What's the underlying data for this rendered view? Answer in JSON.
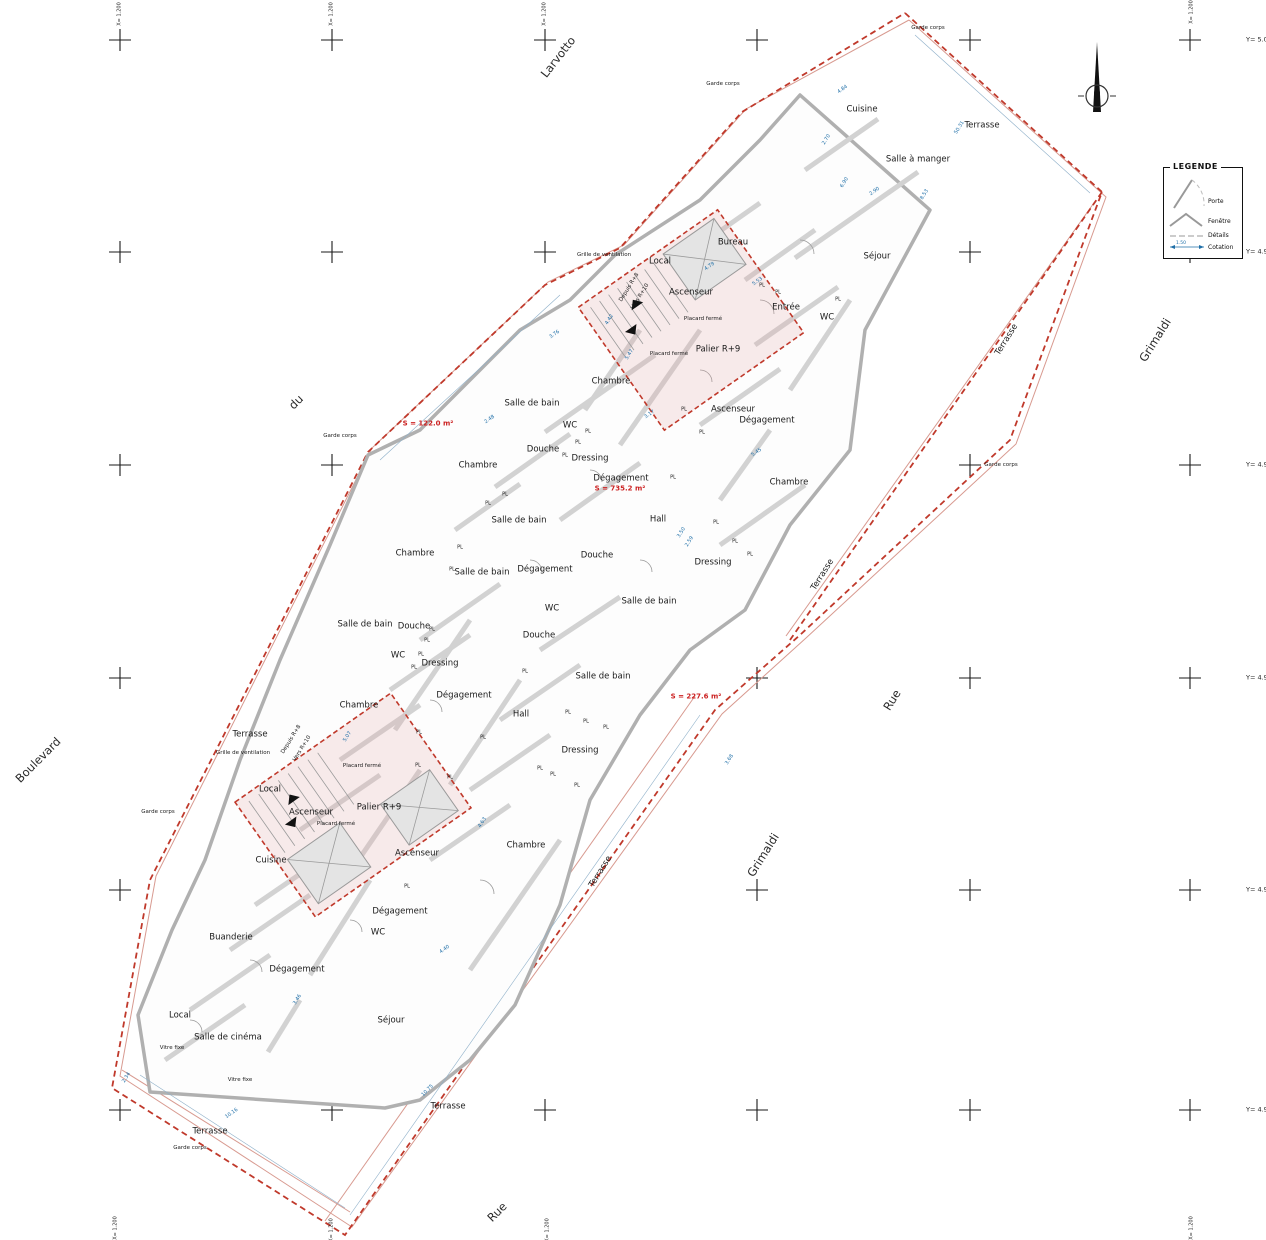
{
  "plan": {
    "level_name": "Palier R+9",
    "boundary_color": "#c0392b",
    "dimension_color": "#1f6fa8",
    "area_color": "#cc2222"
  },
  "legend": {
    "title": "LEGENDE",
    "items": [
      {
        "label": "Porte"
      },
      {
        "label": "Fenêtre"
      },
      {
        "label": "Détails"
      },
      {
        "label": "Cotation"
      }
    ],
    "cotation_value": "1.50"
  },
  "north": {
    "label": "N"
  },
  "grid": {
    "cols": [
      120,
      332,
      545,
      757,
      970,
      1190
    ],
    "rows": [
      40,
      252,
      465,
      678,
      890,
      1110
    ],
    "y_labels": [
      {
        "t": "Y= 5.000",
        "x": 1246,
        "y": 40
      },
      {
        "t": "Y= 4.990",
        "x": 1246,
        "y": 252
      },
      {
        "t": "Y= 4.980",
        "x": 1246,
        "y": 465
      },
      {
        "t": "Y= 4.970",
        "x": 1246,
        "y": 678
      },
      {
        "t": "Y= 4.960",
        "x": 1246,
        "y": 890
      },
      {
        "t": "Y= 4.950",
        "x": 1246,
        "y": 1110
      }
    ],
    "x_labels": [
      {
        "t": "X= 1.200",
        "x": 120,
        "y": 14
      },
      {
        "t": "X= 1.200",
        "x": 332,
        "y": 14
      },
      {
        "t": "X= 1.200",
        "x": 545,
        "y": 14
      },
      {
        "t": "X= 1.200",
        "x": 1192,
        "y": 12
      },
      {
        "t": "X= 1.200",
        "x": 116,
        "y": 1228
      },
      {
        "t": "X= 1.200",
        "x": 332,
        "y": 1230
      },
      {
        "t": "X= 1.200",
        "x": 548,
        "y": 1230
      },
      {
        "t": "X= 1.200",
        "x": 1192,
        "y": 1228
      }
    ]
  },
  "labels": [
    {
      "t": "Larvotto",
      "x": 558,
      "y": 57,
      "r": -52,
      "c": "street"
    },
    {
      "t": "du",
      "x": 296,
      "y": 402,
      "r": -45,
      "c": "street"
    },
    {
      "t": "Boulevard",
      "x": 38,
      "y": 760,
      "r": -45,
      "c": "street"
    },
    {
      "t": "Grimaldi",
      "x": 1155,
      "y": 340,
      "r": -58,
      "c": "street"
    },
    {
      "t": "Grimaldi",
      "x": 763,
      "y": 855,
      "r": -58,
      "c": "street"
    },
    {
      "t": "Rue",
      "x": 892,
      "y": 700,
      "r": -58,
      "c": "street"
    },
    {
      "t": "Rue",
      "x": 497,
      "y": 1212,
      "r": -45,
      "c": "street"
    },
    {
      "t": "S = 122.0 m²",
      "x": 428,
      "y": 424,
      "r": 0,
      "c": "area"
    },
    {
      "t": "S = 735.2 m²",
      "x": 620,
      "y": 489,
      "r": 0,
      "c": "area"
    },
    {
      "t": "S = 227.6 m²",
      "x": 696,
      "y": 697,
      "r": 0,
      "c": "area"
    },
    {
      "t": "Cuisine",
      "x": 862,
      "y": 110,
      "r": 0,
      "c": "room"
    },
    {
      "t": "Terrasse",
      "x": 982,
      "y": 126,
      "r": 0,
      "c": "room"
    },
    {
      "t": "Salle à manger",
      "x": 918,
      "y": 160,
      "r": 0,
      "c": "room"
    },
    {
      "t": "Séjour",
      "x": 877,
      "y": 257,
      "r": 0,
      "c": "room"
    },
    {
      "t": "Bureau",
      "x": 733,
      "y": 243,
      "r": 0,
      "c": "room"
    },
    {
      "t": "Local",
      "x": 660,
      "y": 262,
      "r": 0,
      "c": "room"
    },
    {
      "t": "Ascenseur",
      "x": 691,
      "y": 293,
      "r": 0,
      "c": "room"
    },
    {
      "t": "Entrée",
      "x": 786,
      "y": 308,
      "r": 0,
      "c": "room"
    },
    {
      "t": "WC",
      "x": 827,
      "y": 318,
      "r": 0,
      "c": "room"
    },
    {
      "t": "Palier R+9",
      "x": 718,
      "y": 350,
      "r": 0,
      "c": "room"
    },
    {
      "t": "Ascenseur",
      "x": 733,
      "y": 410,
      "r": 0,
      "c": "room"
    },
    {
      "t": "Dégagement",
      "x": 767,
      "y": 421,
      "r": 0,
      "c": "room"
    },
    {
      "t": "Chambre",
      "x": 789,
      "y": 483,
      "r": 0,
      "c": "room"
    },
    {
      "t": "Terrasse",
      "x": 823,
      "y": 575,
      "r": -58,
      "c": "room"
    },
    {
      "t": "Terrasse",
      "x": 1007,
      "y": 340,
      "r": -58,
      "c": "room"
    },
    {
      "t": "Chambre",
      "x": 611,
      "y": 382,
      "r": 0,
      "c": "room"
    },
    {
      "t": "Salle de bain",
      "x": 532,
      "y": 404,
      "r": 0,
      "c": "room"
    },
    {
      "t": "WC",
      "x": 570,
      "y": 426,
      "r": 0,
      "c": "room"
    },
    {
      "t": "Douche",
      "x": 543,
      "y": 450,
      "r": 0,
      "c": "room"
    },
    {
      "t": "Dressing",
      "x": 590,
      "y": 459,
      "r": 0,
      "c": "room"
    },
    {
      "t": "Dégagement",
      "x": 621,
      "y": 479,
      "r": 0,
      "c": "room"
    },
    {
      "t": "Chambre",
      "x": 478,
      "y": 466,
      "r": 0,
      "c": "room"
    },
    {
      "t": "Salle de bain",
      "x": 519,
      "y": 521,
      "r": 0,
      "c": "room"
    },
    {
      "t": "Dégagement",
      "x": 545,
      "y": 570,
      "r": 0,
      "c": "room"
    },
    {
      "t": "Chambre",
      "x": 415,
      "y": 554,
      "r": 0,
      "c": "room"
    },
    {
      "t": "Salle de bain",
      "x": 482,
      "y": 573,
      "r": 0,
      "c": "room"
    },
    {
      "t": "WC",
      "x": 552,
      "y": 609,
      "r": 0,
      "c": "room"
    },
    {
      "t": "Douche",
      "x": 597,
      "y": 556,
      "r": 0,
      "c": "room"
    },
    {
      "t": "Hall",
      "x": 658,
      "y": 520,
      "r": 0,
      "c": "room"
    },
    {
      "t": "Douche",
      "x": 539,
      "y": 636,
      "r": 0,
      "c": "room"
    },
    {
      "t": "Salle de bain",
      "x": 365,
      "y": 625,
      "r": 0,
      "c": "room"
    },
    {
      "t": "Douche",
      "x": 414,
      "y": 627,
      "r": 0,
      "c": "room"
    },
    {
      "t": "WC",
      "x": 398,
      "y": 656,
      "r": 0,
      "c": "room"
    },
    {
      "t": "Dressing",
      "x": 440,
      "y": 664,
      "r": 0,
      "c": "room"
    },
    {
      "t": "Dégagement",
      "x": 464,
      "y": 696,
      "r": 0,
      "c": "room"
    },
    {
      "t": "Chambre",
      "x": 359,
      "y": 706,
      "r": 0,
      "c": "room"
    },
    {
      "t": "Salle de bain",
      "x": 603,
      "y": 677,
      "r": 0,
      "c": "room"
    },
    {
      "t": "Dressing",
      "x": 580,
      "y": 751,
      "r": 0,
      "c": "room"
    },
    {
      "t": "Salle de bain",
      "x": 649,
      "y": 602,
      "r": 0,
      "c": "room"
    },
    {
      "t": "Dressing",
      "x": 713,
      "y": 563,
      "r": 0,
      "c": "room"
    },
    {
      "t": "Hall",
      "x": 521,
      "y": 715,
      "r": 0,
      "c": "room"
    },
    {
      "t": "Terrasse",
      "x": 250,
      "y": 735,
      "r": 0,
      "c": "room"
    },
    {
      "t": "Local",
      "x": 270,
      "y": 790,
      "r": 0,
      "c": "room"
    },
    {
      "t": "Ascenseur",
      "x": 311,
      "y": 813,
      "r": 0,
      "c": "room"
    },
    {
      "t": "Palier R+9",
      "x": 379,
      "y": 808,
      "r": 0,
      "c": "room"
    },
    {
      "t": "Ascenseur",
      "x": 417,
      "y": 854,
      "r": 0,
      "c": "room"
    },
    {
      "t": "Cuisine",
      "x": 271,
      "y": 861,
      "r": 0,
      "c": "room"
    },
    {
      "t": "Chambre",
      "x": 526,
      "y": 846,
      "r": 0,
      "c": "room"
    },
    {
      "t": "Dégagement",
      "x": 400,
      "y": 912,
      "r": 0,
      "c": "room"
    },
    {
      "t": "WC",
      "x": 378,
      "y": 933,
      "r": 0,
      "c": "room"
    },
    {
      "t": "Buanderie",
      "x": 231,
      "y": 938,
      "r": 0,
      "c": "room"
    },
    {
      "t": "Dégagement",
      "x": 297,
      "y": 970,
      "r": 0,
      "c": "room"
    },
    {
      "t": "Local",
      "x": 180,
      "y": 1016,
      "r": 0,
      "c": "room"
    },
    {
      "t": "Salle de cinéma",
      "x": 228,
      "y": 1038,
      "r": 0,
      "c": "room"
    },
    {
      "t": "Séjour",
      "x": 391,
      "y": 1021,
      "r": 0,
      "c": "room"
    },
    {
      "t": "Terrasse",
      "x": 601,
      "y": 872,
      "r": -58,
      "c": "room"
    },
    {
      "t": "Terrasse",
      "x": 448,
      "y": 1107,
      "r": 0,
      "c": "room"
    },
    {
      "t": "Terrasse",
      "x": 210,
      "y": 1132,
      "r": 0,
      "c": "room"
    },
    {
      "t": "Garde corps",
      "x": 340,
      "y": 437,
      "r": 0,
      "c": "tiny"
    },
    {
      "t": "Garde corps",
      "x": 723,
      "y": 85,
      "r": 0,
      "c": "tiny"
    },
    {
      "t": "Garde corps",
      "x": 928,
      "y": 29,
      "r": 0,
      "c": "tiny"
    },
    {
      "t": "Garde corps",
      "x": 1001,
      "y": 466,
      "r": 0,
      "c": "tiny"
    },
    {
      "t": "Garde corps",
      "x": 158,
      "y": 813,
      "r": 0,
      "c": "tiny"
    },
    {
      "t": "Garde corps",
      "x": 190,
      "y": 1149,
      "r": 0,
      "c": "tiny"
    },
    {
      "t": "Grille de ventilation",
      "x": 604,
      "y": 256,
      "r": 0,
      "c": "tiny"
    },
    {
      "t": "Grille de ventilation",
      "x": 243,
      "y": 754,
      "r": 0,
      "c": "tiny"
    },
    {
      "t": "Placard fermé",
      "x": 703,
      "y": 320,
      "r": 0,
      "c": "tiny"
    },
    {
      "t": "Placard fermé",
      "x": 669,
      "y": 355,
      "r": 0,
      "c": "tiny"
    },
    {
      "t": "Placard fermé",
      "x": 362,
      "y": 767,
      "r": 0,
      "c": "tiny"
    },
    {
      "t": "Placard fermé",
      "x": 336,
      "y": 825,
      "r": 0,
      "c": "tiny"
    },
    {
      "t": "Vitre fixe",
      "x": 172,
      "y": 1049,
      "r": 0,
      "c": "tiny"
    },
    {
      "t": "Vitre fixe",
      "x": 240,
      "y": 1081,
      "r": 0,
      "c": "tiny"
    },
    {
      "t": "Depuis R+8",
      "x": 630,
      "y": 288,
      "r": -58,
      "c": "tiny"
    },
    {
      "t": "Vers R+10",
      "x": 641,
      "y": 297,
      "r": -58,
      "c": "tiny"
    },
    {
      "t": "Depuis R+8",
      "x": 292,
      "y": 740,
      "r": -58,
      "c": "tiny"
    },
    {
      "t": "Vers R+10",
      "x": 303,
      "y": 749,
      "r": -58,
      "c": "tiny"
    },
    {
      "t": "PL",
      "x": 684,
      "y": 410,
      "r": 0,
      "c": "pl"
    },
    {
      "t": "PL",
      "x": 702,
      "y": 433,
      "r": 0,
      "c": "pl"
    },
    {
      "t": "PL",
      "x": 673,
      "y": 478,
      "r": 0,
      "c": "pl"
    },
    {
      "t": "PL",
      "x": 716,
      "y": 523,
      "r": 0,
      "c": "pl"
    },
    {
      "t": "PL",
      "x": 735,
      "y": 542,
      "r": 0,
      "c": "pl"
    },
    {
      "t": "PL",
      "x": 750,
      "y": 555,
      "r": 0,
      "c": "pl"
    },
    {
      "t": "PL",
      "x": 588,
      "y": 432,
      "r": 0,
      "c": "pl"
    },
    {
      "t": "PL",
      "x": 578,
      "y": 443,
      "r": 0,
      "c": "pl"
    },
    {
      "t": "PL",
      "x": 565,
      "y": 456,
      "r": 0,
      "c": "pl"
    },
    {
      "t": "PL",
      "x": 525,
      "y": 672,
      "r": 0,
      "c": "pl"
    },
    {
      "t": "PL",
      "x": 452,
      "y": 570,
      "r": 0,
      "c": "pl"
    },
    {
      "t": "PL",
      "x": 483,
      "y": 738,
      "r": 0,
      "c": "pl"
    },
    {
      "t": "PL",
      "x": 568,
      "y": 713,
      "r": 0,
      "c": "pl"
    },
    {
      "t": "PL",
      "x": 586,
      "y": 722,
      "r": 0,
      "c": "pl"
    },
    {
      "t": "PL",
      "x": 606,
      "y": 728,
      "r": 0,
      "c": "pl"
    },
    {
      "t": "PL",
      "x": 540,
      "y": 769,
      "r": 0,
      "c": "pl"
    },
    {
      "t": "PL",
      "x": 553,
      "y": 775,
      "r": 0,
      "c": "pl"
    },
    {
      "t": "PL",
      "x": 577,
      "y": 786,
      "r": 0,
      "c": "pl"
    },
    {
      "t": "PL",
      "x": 418,
      "y": 766,
      "r": 0,
      "c": "pl"
    },
    {
      "t": "PL",
      "x": 450,
      "y": 778,
      "r": 0,
      "c": "pl"
    },
    {
      "t": "PL",
      "x": 419,
      "y": 733,
      "r": 0,
      "c": "pl"
    },
    {
      "t": "PL",
      "x": 407,
      "y": 887,
      "r": 0,
      "c": "pl"
    },
    {
      "t": "PL",
      "x": 432,
      "y": 630,
      "r": 0,
      "c": "pl"
    },
    {
      "t": "PL",
      "x": 427,
      "y": 641,
      "r": 0,
      "c": "pl"
    },
    {
      "t": "PL",
      "x": 421,
      "y": 655,
      "r": 0,
      "c": "pl"
    },
    {
      "t": "PL",
      "x": 414,
      "y": 668,
      "r": 0,
      "c": "pl"
    },
    {
      "t": "PL",
      "x": 460,
      "y": 548,
      "r": 0,
      "c": "pl"
    },
    {
      "t": "PL",
      "x": 762,
      "y": 286,
      "r": 0,
      "c": "pl"
    },
    {
      "t": "PL",
      "x": 778,
      "y": 293,
      "r": 0,
      "c": "pl"
    },
    {
      "t": "PL",
      "x": 838,
      "y": 300,
      "r": 0,
      "c": "pl"
    },
    {
      "t": "PL",
      "x": 505,
      "y": 495,
      "r": 0,
      "c": "pl"
    },
    {
      "t": "PL",
      "x": 488,
      "y": 504,
      "r": 0,
      "c": "pl"
    },
    {
      "t": "4.84",
      "x": 843,
      "y": 90,
      "r": -35,
      "c": "dim"
    },
    {
      "t": "2.70",
      "x": 827,
      "y": 140,
      "r": -58,
      "c": "dim"
    },
    {
      "t": "6.90",
      "x": 845,
      "y": 183,
      "r": -58,
      "c": "dim"
    },
    {
      "t": "2.90",
      "x": 875,
      "y": 192,
      "r": -35,
      "c": "dim"
    },
    {
      "t": "50.31",
      "x": 960,
      "y": 128,
      "r": -58,
      "c": "dim"
    },
    {
      "t": "8.53",
      "x": 925,
      "y": 195,
      "r": -58,
      "c": "dim"
    },
    {
      "t": "4.79",
      "x": 710,
      "y": 267,
      "r": -35,
      "c": "dim"
    },
    {
      "t": "5.53",
      "x": 758,
      "y": 282,
      "r": -35,
      "c": "dim"
    },
    {
      "t": "5.47",
      "x": 630,
      "y": 355,
      "r": -58,
      "c": "dim"
    },
    {
      "t": "3.17",
      "x": 650,
      "y": 415,
      "r": -35,
      "c": "dim"
    },
    {
      "t": "5.45",
      "x": 757,
      "y": 453,
      "r": -35,
      "c": "dim"
    },
    {
      "t": "3.50",
      "x": 682,
      "y": 533,
      "r": -58,
      "c": "dim"
    },
    {
      "t": "2.59",
      "x": 690,
      "y": 542,
      "r": -58,
      "c": "dim"
    },
    {
      "t": "4.63",
      "x": 483,
      "y": 823,
      "r": -58,
      "c": "dim"
    },
    {
      "t": "2.34",
      "x": 127,
      "y": 1078,
      "r": -58,
      "c": "dim"
    },
    {
      "t": "10.16",
      "x": 232,
      "y": 1114,
      "r": -35,
      "c": "dim"
    },
    {
      "t": "10.75",
      "x": 428,
      "y": 1091,
      "r": -45,
      "c": "dim"
    },
    {
      "t": "5.07",
      "x": 348,
      "y": 737,
      "r": -58,
      "c": "dim"
    },
    {
      "t": "3.46",
      "x": 298,
      "y": 1000,
      "r": -58,
      "c": "dim"
    },
    {
      "t": "4.40",
      "x": 445,
      "y": 950,
      "r": -35,
      "c": "dim"
    },
    {
      "t": "2.48",
      "x": 490,
      "y": 420,
      "r": -35,
      "c": "dim"
    },
    {
      "t": "3.76",
      "x": 555,
      "y": 335,
      "r": -35,
      "c": "dim"
    },
    {
      "t": "4.42",
      "x": 610,
      "y": 320,
      "r": -58,
      "c": "dim"
    },
    {
      "t": "3.68",
      "x": 730,
      "y": 760,
      "r": -58,
      "c": "dim"
    }
  ]
}
